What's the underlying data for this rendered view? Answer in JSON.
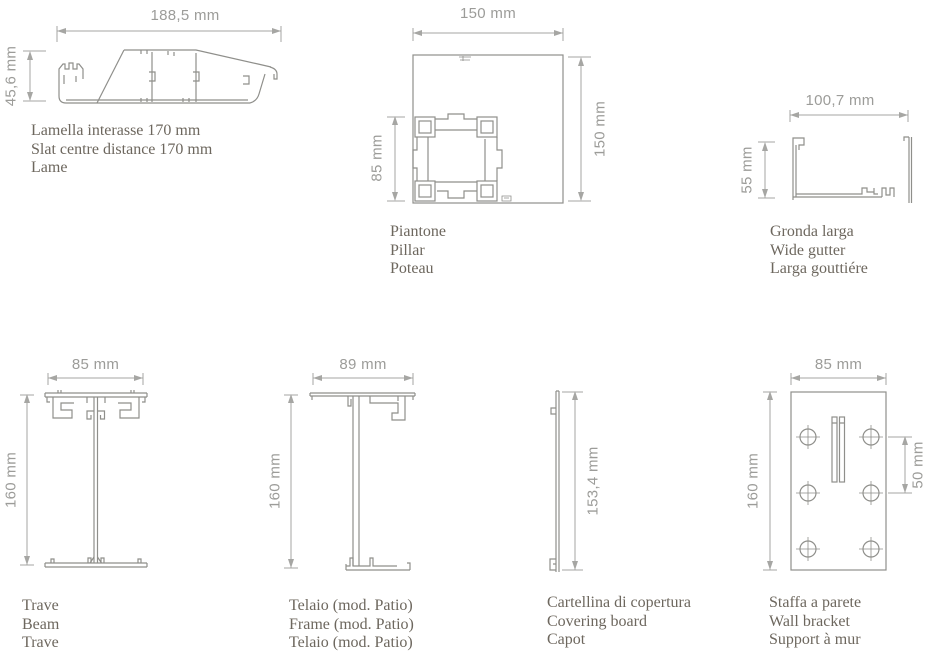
{
  "palette": {
    "background": "#ffffff",
    "profile_line": "#8f8f8b",
    "dimension_line": "#a6a6a3",
    "dimension_text": "#9c9c99",
    "caption_text": "#6d675e"
  },
  "figures": {
    "slat": {
      "width_dim": "188,5 mm",
      "height_dim": "45,6 mm",
      "captions": [
        "Lamella interasse 170 mm",
        "Slat centre distance 170 mm",
        "Lame"
      ]
    },
    "pillar": {
      "width_dim": "150 mm",
      "height_dim": "150 mm",
      "inner_dim": "85 mm",
      "captions": [
        "Piantone",
        "Pillar",
        "Poteau"
      ]
    },
    "gutter": {
      "width_dim": "100,7 mm",
      "height_dim": "55 mm",
      "captions": [
        "Gronda larga",
        "Wide gutter",
        "Larga gouttiére"
      ]
    },
    "beam": {
      "width_dim": "85 mm",
      "height_dim": "160 mm",
      "captions": [
        "Trave",
        "Beam",
        "Trave"
      ]
    },
    "frame": {
      "width_dim": "89 mm",
      "height_dim": "160 mm",
      "captions": [
        "Telaio (mod. Patio)",
        "Frame (mod. Patio)",
        "Telaio (mod. Patio)"
      ]
    },
    "covering_board": {
      "height_dim": "153,4 mm",
      "captions": [
        "Cartellina di copertura",
        "Covering board",
        "Capot"
      ]
    },
    "bracket": {
      "width_dim": "85 mm",
      "height_dim": "160 mm",
      "hole_spacing_dim": "50 mm",
      "captions": [
        "Staffa a parete",
        "Wall bracket",
        "Support à mur"
      ]
    }
  }
}
